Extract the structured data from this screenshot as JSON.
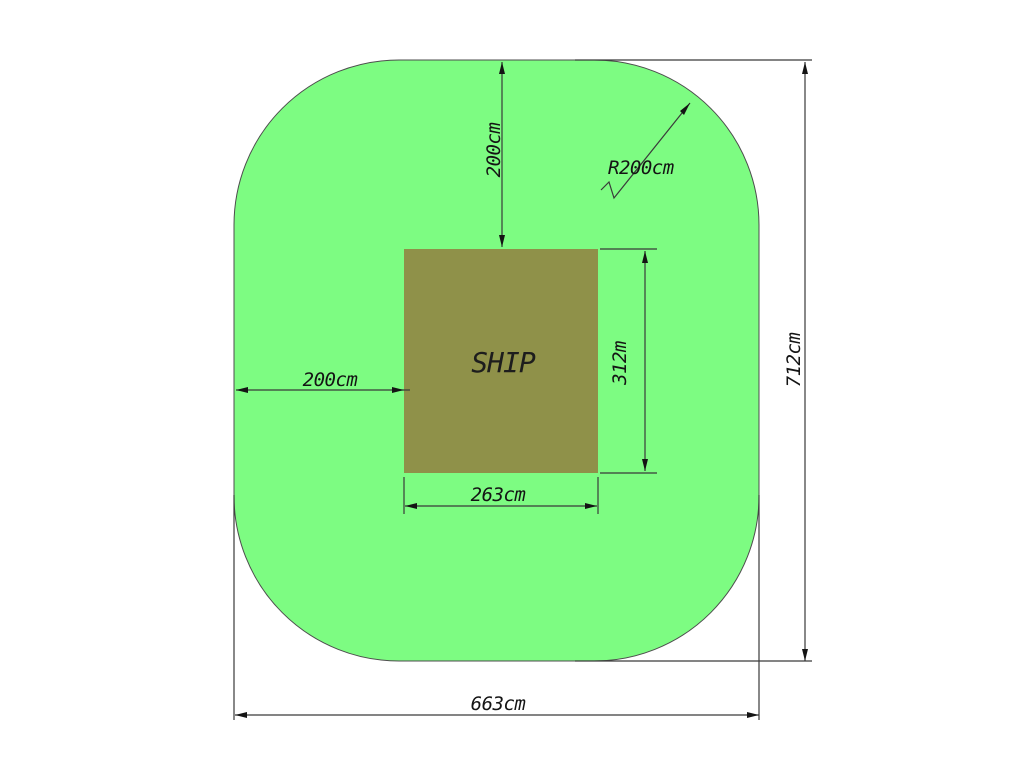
{
  "diagram": {
    "title": "ship-safety-zone-plan",
    "ship": {
      "label": "SHIP"
    },
    "dimensions": {
      "top_offset": {
        "label": "200cm"
      },
      "corner_radius": {
        "label": "R200cm"
      },
      "left_offset": {
        "label": "200cm"
      },
      "ship_height": {
        "label": "312m"
      },
      "ship_width": {
        "label": "263cm"
      },
      "overall_height": {
        "label": "712cm"
      },
      "overall_width": {
        "label": "663cm"
      }
    },
    "colors": {
      "zone_fill": "#7dfc82",
      "zone_stroke": "#4d4d4d",
      "ship_fill": "#8f9149",
      "dimension_line": "#3a3a3a",
      "text": "#141414",
      "background": "#ffffff"
    }
  }
}
